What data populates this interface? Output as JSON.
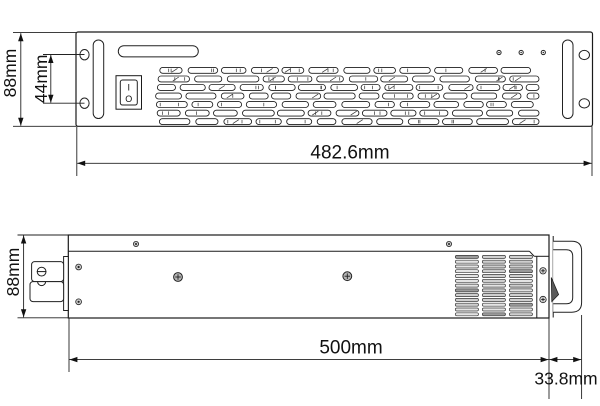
{
  "front_view": {
    "dim_height_label": "88mm",
    "dim_hole_spacing_label": "44mm",
    "dim_width_label": "482.6mm",
    "power_switch": {
      "on_label": "I",
      "off_label": "O"
    },
    "led_count": 3
  },
  "side_view": {
    "dim_height_label": "88mm",
    "dim_length_label": "500mm",
    "dim_handle_label": "33.8mm"
  },
  "colors": {
    "line": "#1a1a1a",
    "background": "#ffffff"
  }
}
